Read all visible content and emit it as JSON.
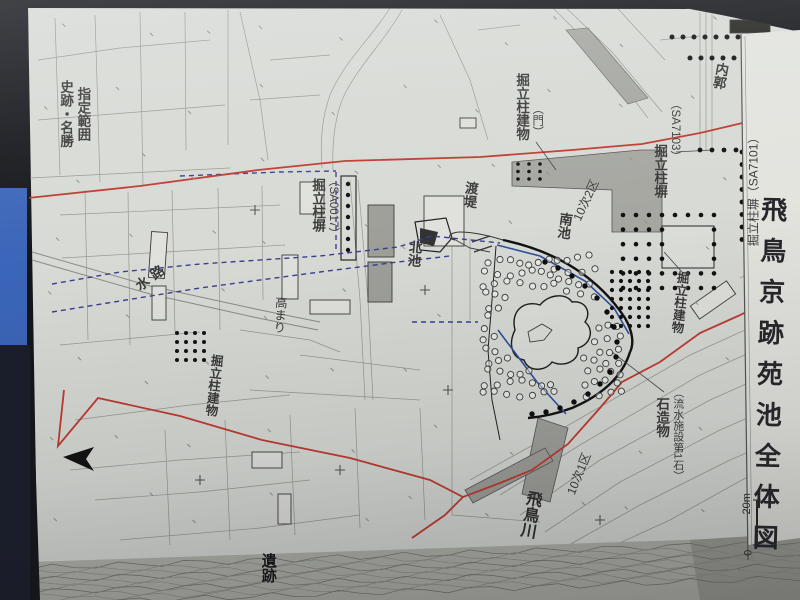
{
  "title": {
    "text": "飛鳥京跡苑池全体図"
  },
  "labels": {
    "designation_line1": "史跡・名勝",
    "designation_line2": "指定範囲",
    "fence_sa0017_name": "掘立柱塀",
    "fence_sa0017_id": "（SA0017）",
    "waterway": "水路",
    "mound": "高まり",
    "building_left": "掘立柱建物",
    "north_pond": "北池",
    "crossing_bank": "渡堤",
    "south_pond": "南池",
    "area_10_2": "10次2区",
    "gate_building_name": "掘立柱建物",
    "gate_building_note": "（門）",
    "fence_sa7103_name": "掘立柱塀",
    "fence_sa7103_id": "（SA7103）",
    "inner_enclosure": "内郭",
    "fence_sa7101": "掘立柱塀（SA7101）",
    "building_right": "掘立柱建物",
    "stone_object_name": "石造物",
    "stone_object_note": "（流水施設第1石）",
    "asuka_river": "飛鳥川",
    "area_10_1": "10次1区",
    "ruins": "遺跡"
  },
  "scale": {
    "zero": "0",
    "label": "20m"
  },
  "colors": {
    "paper": "#d8dad5",
    "margin_paper": "#e3e4de",
    "boundary_red": "#c03a30",
    "survey_blue_dashed": "#3b3f8f",
    "excavation_blue": "#2f4f9e",
    "linework_gray": "#97988f",
    "trench_gray": "#a6a7a1",
    "feature_black": "#1c1c1c",
    "photo_background": "#131418",
    "glare_blue": "#4273d6"
  }
}
